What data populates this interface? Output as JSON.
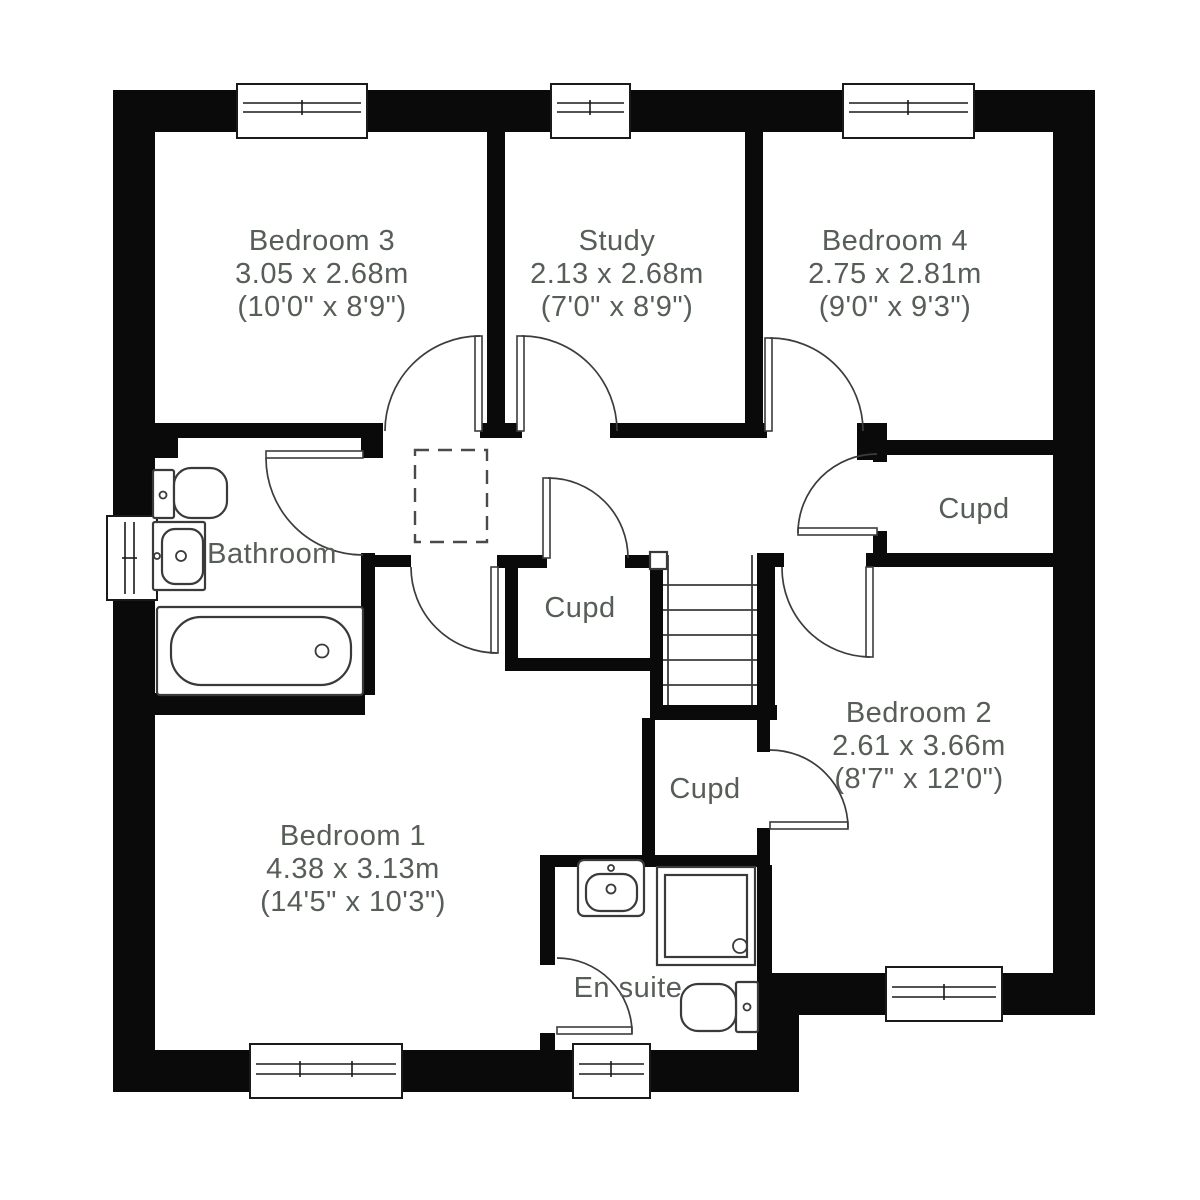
{
  "colors": {
    "wall": "#0a0a0a",
    "line": "#3c3c3c",
    "text": "#575d57",
    "background": "#ffffff"
  },
  "rooms": [
    {
      "name": "Bedroom 3",
      "metric": "3.05 x 2.68m",
      "imperial": "(10'0\" x 8'9\")"
    },
    {
      "name": "Study",
      "metric": "2.13 x 2.68m",
      "imperial": "(7'0\" x 8'9\")"
    },
    {
      "name": "Bedroom 4",
      "metric": "2.75 x 2.81m",
      "imperial": "(9'0\" x 9'3\")"
    },
    {
      "name": "Bathroom"
    },
    {
      "name": "Cupd"
    },
    {
      "name": "Cupd"
    },
    {
      "name": "Cupd"
    },
    {
      "name": "Bedroom 2",
      "metric": "2.61 x 3.66m",
      "imperial": "(8'7\" x 12'0\")"
    },
    {
      "name": "Bedroom 1",
      "metric": "4.38 x 3.13m",
      "imperial": "(14'5\" x 10'3\")"
    },
    {
      "name": "En suite"
    }
  ]
}
